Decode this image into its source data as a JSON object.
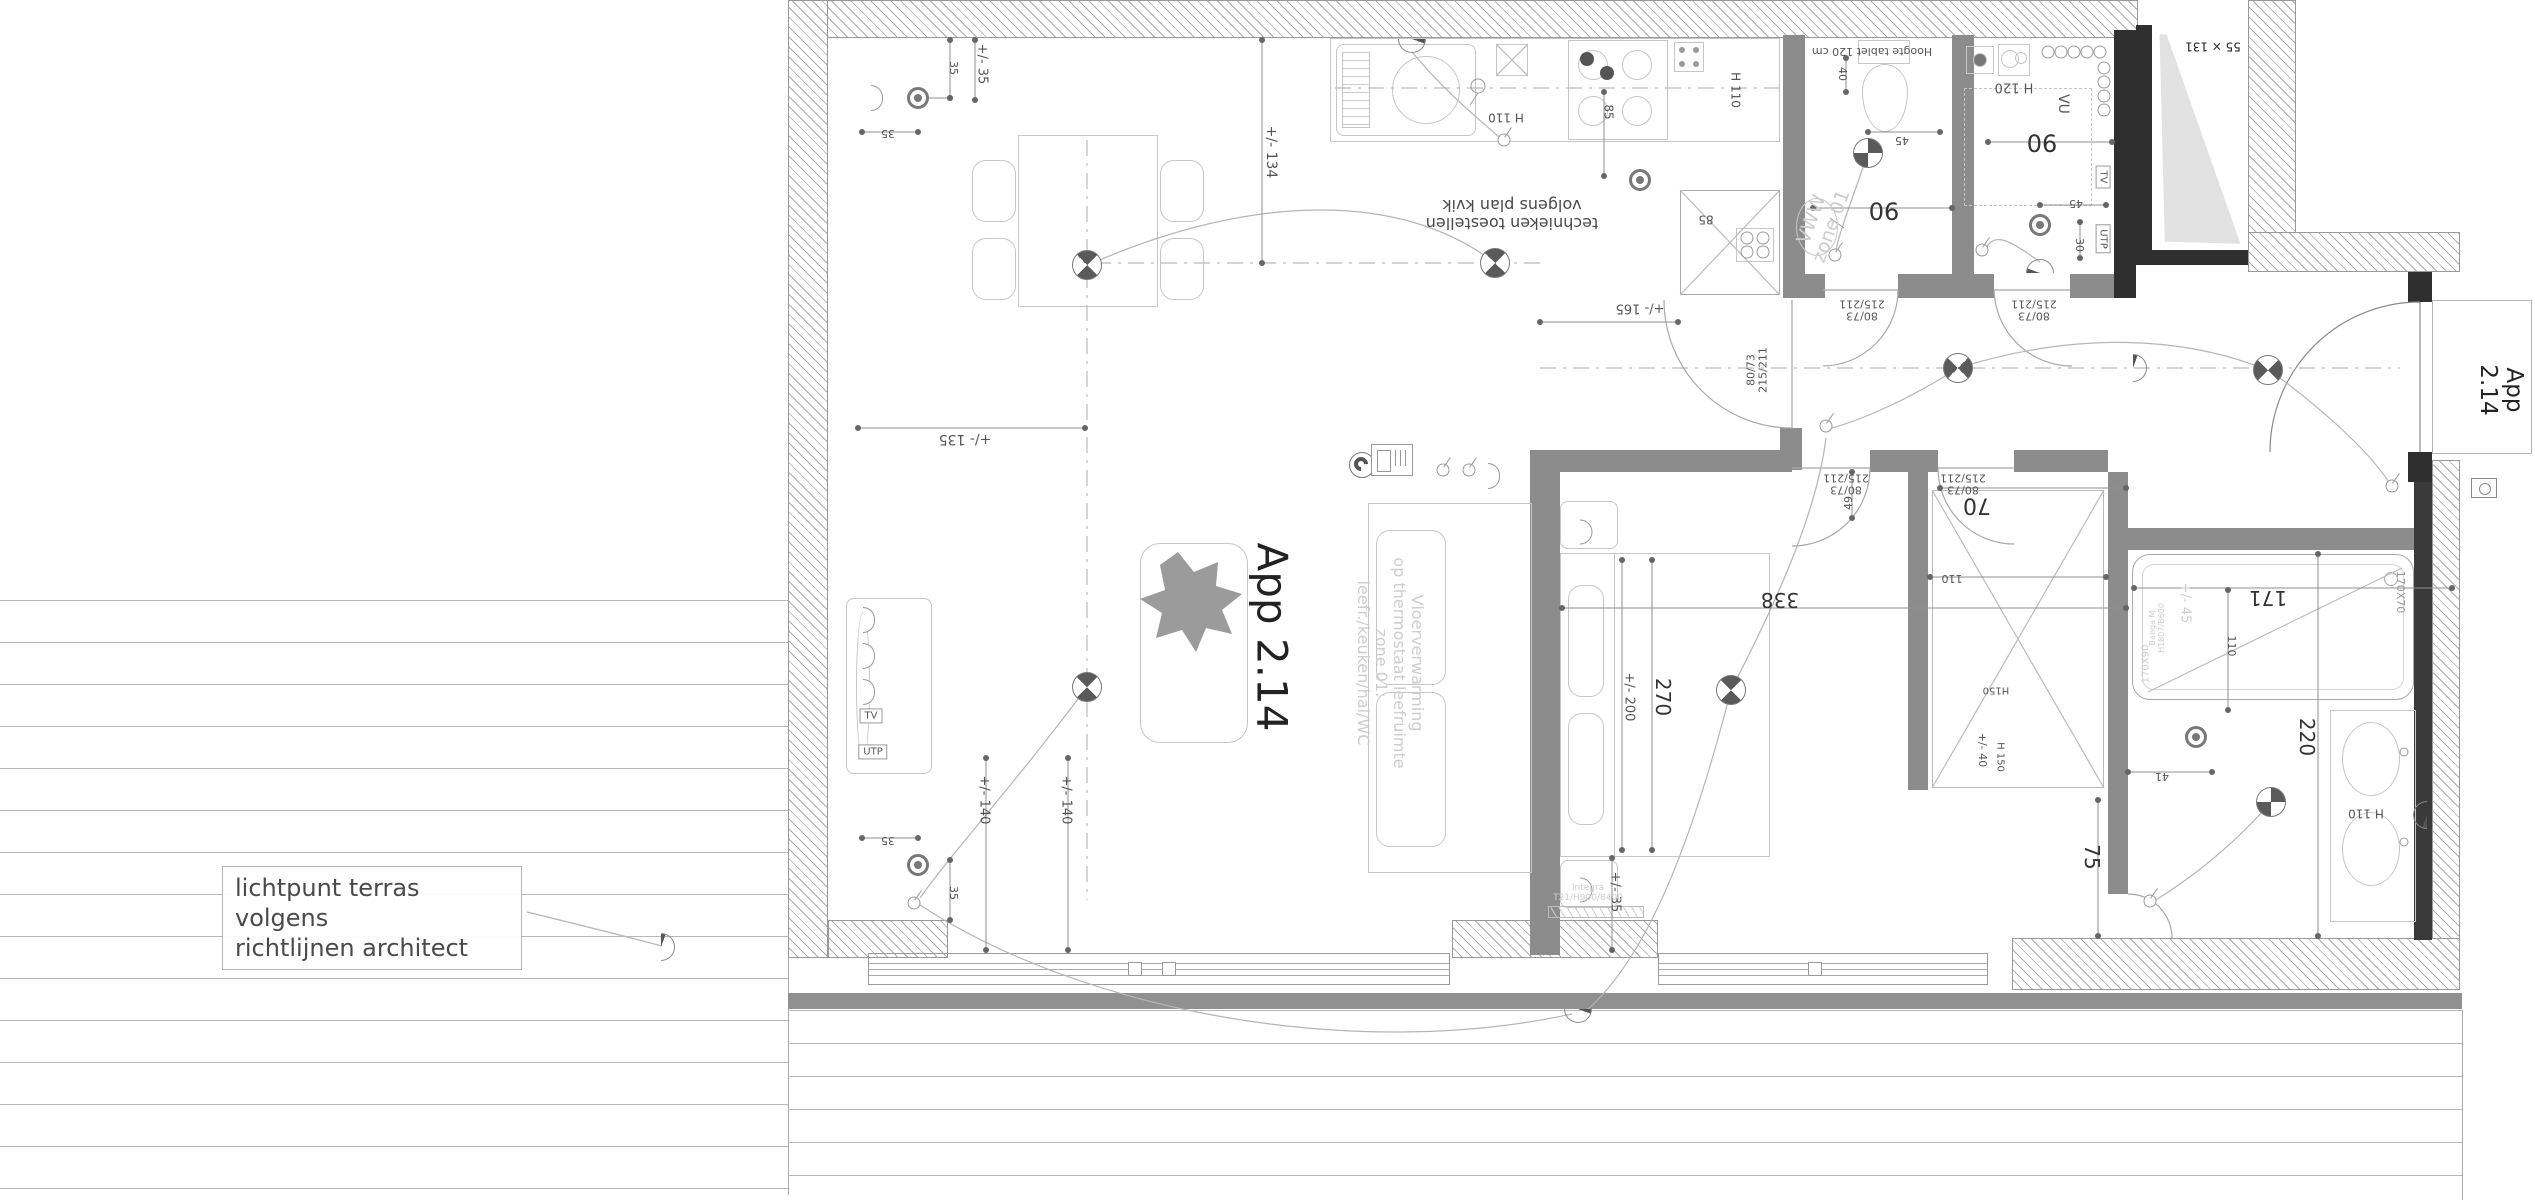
{
  "title": "App 2.14 - electrical floor plan",
  "note": {
    "line1": "lichtpunt terras volgens",
    "line2": "richtlijnen architect"
  },
  "colors": {
    "interior_wall": "#8c8c8c",
    "structure_dark": "#2f2f2f",
    "furniture_line": "#c6c6c6",
    "dim_text": "#555555",
    "faint_text": "#cdcdcd"
  },
  "labels": [
    {
      "name": "apartment-label-main",
      "text": "App 2.14",
      "x": 1272,
      "y": 637,
      "rot": 90,
      "fs": 42,
      "color": "#222"
    },
    {
      "name": "apartment-label-entrance",
      "text": "App 2.14",
      "x": 2500,
      "y": 390,
      "rot": 90,
      "fs": 23,
      "color": "#222"
    },
    {
      "name": "floorheating-watermark",
      "text": "Vloerverwarming\nop thermostaat leefruimte\nzone 01:\nleefr./keuken/hal/WC",
      "x": 1390,
      "y": 663,
      "rot": 90,
      "fs": 16,
      "cls": "faint"
    },
    {
      "name": "kitchen-note",
      "text": "technieken toestellen\nvolgens plan kvik",
      "x": 1512,
      "y": 214,
      "rot": 180,
      "fs": 16,
      "color": "#4a4a4a"
    },
    {
      "name": "dim-35a",
      "text": "+/- 35",
      "x": 981,
      "y": 64,
      "rot": 90,
      "fs": 13
    },
    {
      "name": "dim-35b",
      "text": "35",
      "x": 953,
      "y": 68,
      "rot": 90,
      "fs": 11
    },
    {
      "name": "dim-35c",
      "text": "35",
      "x": 888,
      "y": 133,
      "rot": 180,
      "fs": 11
    },
    {
      "name": "dim-134",
      "text": "+/- 134",
      "x": 1270,
      "y": 152,
      "rot": 90,
      "fs": 14
    },
    {
      "name": "dim-135",
      "text": "+/- 135",
      "x": 965,
      "y": 438,
      "rot": 180,
      "fs": 14
    },
    {
      "name": "kitchen-h110a",
      "text": "H 110",
      "x": 1506,
      "y": 117,
      "rot": 180,
      "fs": 12
    },
    {
      "name": "kitchen-85a",
      "text": "85",
      "x": 1608,
      "y": 112,
      "rot": 90,
      "fs": 12
    },
    {
      "name": "kitchen-h110b",
      "text": "H 110",
      "x": 1735,
      "y": 90,
      "rot": 90,
      "fs": 12
    },
    {
      "name": "kitchen-85b",
      "text": "85",
      "x": 1706,
      "y": 219,
      "rot": 180,
      "fs": 12
    },
    {
      "name": "dim-165",
      "text": "+/- 165",
      "x": 1640,
      "y": 307,
      "rot": 180,
      "fs": 13
    },
    {
      "name": "door-label-wc",
      "text": "80/73\n215/211",
      "x": 1862,
      "y": 309,
      "rot": 180,
      "fs": 11
    },
    {
      "name": "door-label-berging",
      "text": "80/73\n215/211",
      "x": 2034,
      "y": 309,
      "rot": 180,
      "fs": 11
    },
    {
      "name": "door-label-living",
      "text": "80/73\n215/211",
      "x": 1758,
      "y": 370,
      "rot": -90,
      "fs": 11
    },
    {
      "name": "door-label-bedroom",
      "text": "80/73\n215/211",
      "x": 1846,
      "y": 483,
      "rot": 180,
      "fs": 11
    },
    {
      "name": "door-label-corridor",
      "text": "80/73\n215/211",
      "x": 1963,
      "y": 483,
      "rot": 180,
      "fs": 11
    },
    {
      "name": "dim-90-wc",
      "text": "90",
      "x": 1884,
      "y": 210,
      "rot": 180,
      "fs": 24,
      "color": "#333"
    },
    {
      "name": "dim-90-berging",
      "text": "90",
      "x": 2042,
      "y": 142,
      "rot": 180,
      "fs": 24,
      "color": "#333"
    },
    {
      "name": "wc-note",
      "text": "Hoogte tablet 120 cm",
      "x": 1872,
      "y": 51,
      "rot": 180,
      "fs": 11
    },
    {
      "name": "dim-40",
      "text": "40",
      "x": 1842,
      "y": 74,
      "rot": 90,
      "fs": 11
    },
    {
      "name": "dim-45-wc",
      "text": "45",
      "x": 1902,
      "y": 140,
      "rot": 180,
      "fs": 11
    },
    {
      "name": "dim-45-berging",
      "text": "45",
      "x": 2076,
      "y": 203,
      "rot": 180,
      "fs": 11
    },
    {
      "name": "dim-30",
      "text": "30",
      "x": 2079,
      "y": 245,
      "rot": 90,
      "fs": 11
    },
    {
      "name": "berging-h120",
      "text": "H 120",
      "x": 2014,
      "y": 86,
      "rot": 180,
      "fs": 13
    },
    {
      "name": "berging-vu",
      "text": "VU",
      "x": 2062,
      "y": 104,
      "rot": 90,
      "fs": 14
    },
    {
      "name": "berging-tv",
      "text": "TV",
      "x": 2103,
      "y": 177,
      "rot": 90,
      "fs": 10,
      "cls": "boxedlbl"
    },
    {
      "name": "berging-utp",
      "text": "UTP",
      "x": 2103,
      "y": 239,
      "rot": 90,
      "fs": 10,
      "cls": "boxedlbl"
    },
    {
      "name": "window-size",
      "text": "55 × 131",
      "x": 2213,
      "y": 46,
      "rot": 180,
      "fs": 12,
      "color": "#222"
    },
    {
      "name": "dim-70",
      "text": "70",
      "x": 1977,
      "y": 504,
      "rot": 180,
      "fs": 22,
      "color": "#333"
    },
    {
      "name": "dim-49",
      "text": "49",
      "x": 1849,
      "y": 503,
      "rot": -90,
      "fs": 11
    },
    {
      "name": "dim-110-closet",
      "text": "110",
      "x": 1952,
      "y": 578,
      "rot": 180,
      "fs": 11
    },
    {
      "name": "dim-338",
      "text": "338",
      "x": 1780,
      "y": 600,
      "rot": 180,
      "fs": 20,
      "color": "#333"
    },
    {
      "name": "dim-270",
      "text": "270",
      "x": 1663,
      "y": 697,
      "rot": 90,
      "fs": 20,
      "color": "#333"
    },
    {
      "name": "dim-200",
      "text": "+/- 200",
      "x": 1628,
      "y": 697,
      "rot": 90,
      "fs": 13
    },
    {
      "name": "dim-35-bedroom",
      "text": "+/- 35",
      "x": 1614,
      "y": 892,
      "rot": 90,
      "fs": 13
    },
    {
      "name": "radiator-label",
      "text": "Integra\nT21/H900/8400",
      "x": 1588,
      "y": 893,
      "rot": 0,
      "fs": 9,
      "cls": "faint"
    },
    {
      "name": "dim-35d",
      "text": "35",
      "x": 888,
      "y": 840,
      "rot": 180,
      "fs": 11
    },
    {
      "name": "dim-35e",
      "text": "35",
      "x": 953,
      "y": 893,
      "rot": 90,
      "fs": 11
    },
    {
      "name": "dim-140a",
      "text": "+/- 140",
      "x": 983,
      "y": 800,
      "rot": 90,
      "fs": 13
    },
    {
      "name": "dim-140b",
      "text": "+/- 140",
      "x": 1065,
      "y": 800,
      "rot": 90,
      "fs": 13
    },
    {
      "name": "living-tv",
      "text": "TV",
      "x": 871,
      "y": 716,
      "rot": 0,
      "fs": 10,
      "cls": "boxedlbl"
    },
    {
      "name": "living-utp",
      "text": "UTP",
      "x": 873,
      "y": 752,
      "rot": 0,
      "fs": 10,
      "cls": "boxedlbl"
    },
    {
      "name": "closet-h150a",
      "text": "H150",
      "x": 1996,
      "y": 690,
      "rot": 180,
      "fs": 10
    },
    {
      "name": "closet-h150b",
      "text": "H 150",
      "x": 2000,
      "y": 757,
      "rot": 90,
      "fs": 10
    },
    {
      "name": "dim-40-closet",
      "text": "+/- 40",
      "x": 1982,
      "y": 750,
      "rot": 90,
      "fs": 11
    },
    {
      "name": "dim-41",
      "text": "41",
      "x": 2162,
      "y": 776,
      "rot": 180,
      "fs": 11
    },
    {
      "name": "dim-75",
      "text": "75",
      "x": 2092,
      "y": 857,
      "rot": 90,
      "fs": 20,
      "color": "#333"
    },
    {
      "name": "dim-220",
      "text": "220",
      "x": 2307,
      "y": 737,
      "rot": 90,
      "fs": 20,
      "color": "#333"
    },
    {
      "name": "dim-171",
      "text": "171",
      "x": 2268,
      "y": 598,
      "rot": 180,
      "fs": 20,
      "color": "#333"
    },
    {
      "name": "dim-110-bath",
      "text": "110",
      "x": 2231,
      "y": 646,
      "rot": 90,
      "fs": 11
    },
    {
      "name": "bath-size",
      "text": "170X70",
      "x": 2400,
      "y": 592,
      "rot": 90,
      "fs": 11,
      "color": "#9a9a9a"
    },
    {
      "name": "bath-size-old",
      "text": "170X90",
      "x": 2146,
      "y": 664,
      "rot": -90,
      "fs": 10,
      "cls": "faint"
    },
    {
      "name": "dim-45-bath",
      "text": "+/- 45",
      "x": 2184,
      "y": 603,
      "rot": 90,
      "fs": 13,
      "cls": "faint"
    },
    {
      "name": "bath-model",
      "text": "Banga M\nH1807/B600",
      "x": 2158,
      "y": 628,
      "rot": -90,
      "fs": 8,
      "cls": "faint"
    },
    {
      "name": "bath-h110",
      "text": "H 110",
      "x": 2366,
      "y": 813,
      "rot": 180,
      "fs": 12
    },
    {
      "name": "wc-watermark",
      "text": "VWW\nzone 01",
      "x": 1822,
      "y": 223,
      "rot": -70,
      "fs": 19,
      "cls": "faint"
    }
  ],
  "symbols": [
    {
      "type": "ceiling-light",
      "name": "ceiling-light-dining",
      "x": 1087,
      "y": 265,
      "rot": 0
    },
    {
      "type": "ceiling-light",
      "name": "ceiling-light-kitchen",
      "x": 1495,
      "y": 263,
      "rot": 0
    },
    {
      "type": "ceiling-light",
      "name": "ceiling-light-living",
      "x": 1087,
      "y": 687,
      "rot": 0
    },
    {
      "type": "ceiling-light",
      "name": "ceiling-light-wc",
      "x": 1868,
      "y": 153,
      "rot": 45
    },
    {
      "type": "ceiling-light",
      "name": "ceiling-light-hall-1",
      "x": 1958,
      "y": 368,
      "rot": 90
    },
    {
      "type": "ceiling-light",
      "name": "ceiling-light-hall-2",
      "x": 2268,
      "y": 370,
      "rot": 90
    },
    {
      "type": "ceiling-light",
      "name": "ceiling-light-bedroom",
      "x": 1731,
      "y": 690,
      "rot": 0
    },
    {
      "type": "ceiling-light",
      "name": "ceiling-light-bathroom",
      "x": 2271,
      "y": 802,
      "rot": 45
    },
    {
      "type": "wall-light",
      "name": "wall-light-kitchen",
      "x": 1412,
      "y": 46,
      "rot": 180
    },
    {
      "type": "wall-light",
      "name": "wall-light-berging",
      "x": 2040,
      "y": 266,
      "rot": 0
    },
    {
      "type": "wall-light",
      "name": "wall-light-terrace",
      "x": 668,
      "y": 947,
      "rot": 90
    },
    {
      "type": "wall-light",
      "name": "wall-light-bedroom-out",
      "x": 1578,
      "y": 1016,
      "rot": 180
    },
    {
      "type": "wall-light",
      "name": "wall-light-bathroom",
      "x": 2420,
      "y": 815,
      "rot": -90
    },
    {
      "type": "wall-light",
      "name": "wall-light-entrance",
      "x": 2140,
      "y": 368,
      "rot": 90
    },
    {
      "type": "socket",
      "name": "socket-living-top",
      "x": 918,
      "y": 98
    },
    {
      "type": "socket",
      "name": "socket-living-bottom",
      "x": 918,
      "y": 865
    },
    {
      "type": "socket",
      "name": "socket-kitchen",
      "x": 1640,
      "y": 180
    },
    {
      "type": "socket",
      "name": "socket-berging",
      "x": 2040,
      "y": 225
    },
    {
      "type": "socket",
      "name": "socket-bathroom",
      "x": 2196,
      "y": 737
    },
    {
      "type": "socket-half",
      "name": "socket-wall-living-a",
      "x": 877,
      "y": 98
    },
    {
      "type": "socket-half",
      "name": "socket-wall-tv1",
      "x": 869,
      "y": 620
    },
    {
      "type": "socket-half",
      "name": "socket-wall-tv2",
      "x": 869,
      "y": 656
    },
    {
      "type": "socket-half",
      "name": "socket-wall-tv3",
      "x": 869,
      "y": 692
    },
    {
      "type": "socket-half",
      "name": "socket-hall",
      "x": 1494,
      "y": 476
    },
    {
      "type": "switch",
      "name": "switch-living",
      "x": 914,
      "y": 903
    },
    {
      "type": "switch",
      "name": "switch-kitchen",
      "x": 1504,
      "y": 140
    },
    {
      "type": "switch",
      "name": "switch-hall-1",
      "x": 1443,
      "y": 470
    },
    {
      "type": "switch",
      "name": "switch-hall-2",
      "x": 1469,
      "y": 470
    },
    {
      "type": "switch",
      "name": "switch-bedroom",
      "x": 1826,
      "y": 426
    },
    {
      "type": "switch",
      "name": "switch-bathroom",
      "x": 2150,
      "y": 901
    },
    {
      "type": "switch",
      "name": "switch-entrance",
      "x": 2392,
      "y": 486
    },
    {
      "type": "switch",
      "name": "switch-berging",
      "x": 1982,
      "y": 250
    },
    {
      "type": "switch",
      "name": "switch-wc",
      "x": 1835,
      "y": 255
    },
    {
      "type": "thermostat",
      "name": "thermostat-icon",
      "x": 1362,
      "y": 465
    },
    {
      "type": "panel",
      "name": "intercom-panel-icon",
      "x": 1392,
      "y": 460
    },
    {
      "type": "bell",
      "name": "doorbell-icon",
      "x": 2484,
      "y": 488
    }
  ]
}
